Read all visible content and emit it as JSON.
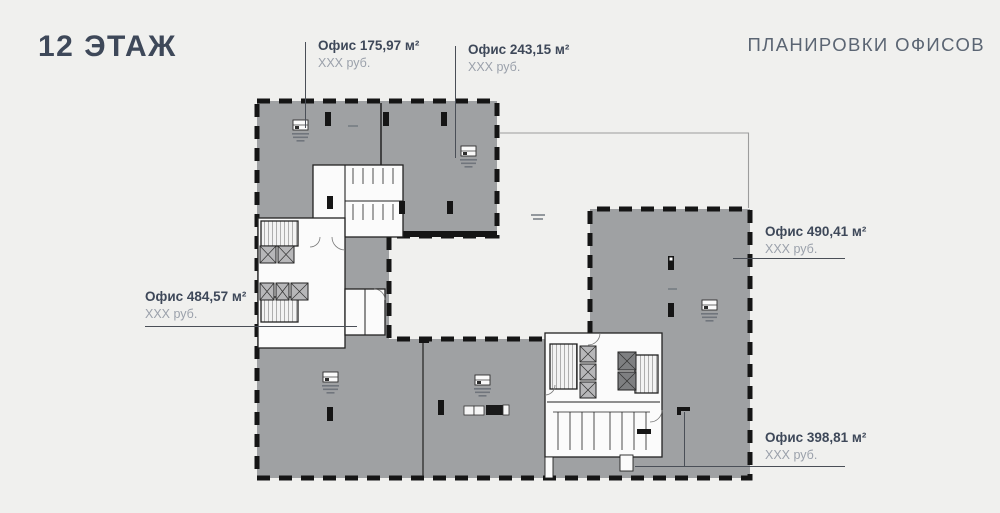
{
  "page": {
    "title": "12 ЭТАЖ",
    "subtitle": "ПЛАНИРОВКИ ОФИСОВ"
  },
  "offices": [
    {
      "id": "office-175",
      "title": "Офис 175,97 м²",
      "price": "XXX руб."
    },
    {
      "id": "office-243",
      "title": "Офис 243,15 м²",
      "price": "XXX руб."
    },
    {
      "id": "office-484",
      "title": "Офис 484,57 м²",
      "price": "XXX руб."
    },
    {
      "id": "office-490",
      "title": "Офис 490,41 м²",
      "price": "XXX руб."
    },
    {
      "id": "office-398",
      "title": "Офис 398,81 м²",
      "price": "XXX руб."
    }
  ],
  "colors": {
    "background": "#f0f0ee",
    "plan_fill": "#9fa1a3",
    "walls": "#151515",
    "title_text": "#3e4859",
    "subtitle_text": "#5b6573",
    "muted_text": "#9ba1ab"
  }
}
